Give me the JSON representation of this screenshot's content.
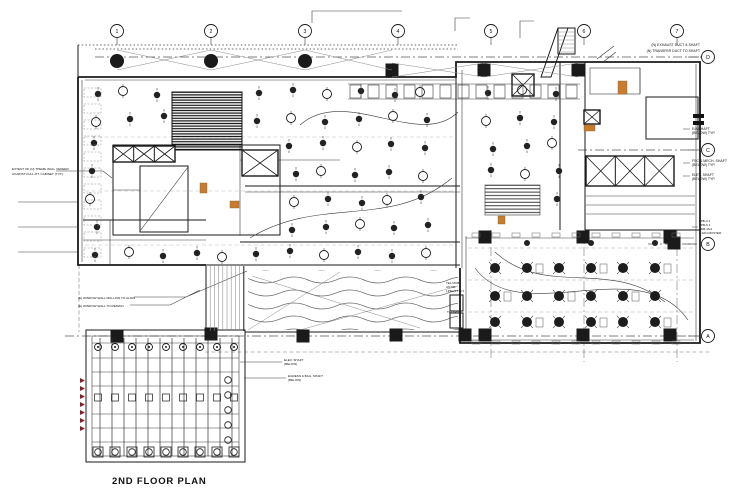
{
  "plan": {
    "title": "2ND FLOOR PLAN"
  },
  "grid": {
    "columns": [
      "1",
      "2",
      "3",
      "4",
      "5",
      "6",
      "7"
    ],
    "rows": [
      "D",
      "C",
      "B",
      "A"
    ]
  },
  "colors": {
    "ink": "#1a1a1a",
    "highlight": "#c87d2e",
    "marker": "#8b1d2c",
    "paper": "#ffffff"
  },
  "annotations": {
    "top_right_1": "(N) EXHAUST DUCT & SHAFT",
    "top_right_2": "(N) TRANSFER DUCT TO SHAFT",
    "right_shaft_1a": "E/A SHAFT",
    "right_shaft_1b": "(BELOW) TYP.",
    "right_shaft_2a": "FSC & MECH. SHAFT",
    "right_shaft_2b": "(BELOW) TYP.",
    "right_shaft_3a": "ELEV. SHAFT",
    "right_shaft_3b": "(BELOW) TYP.",
    "right_tags": [
      "LPB-4.1",
      "TPB-6.1",
      "TDB-16.2",
      "1 FAN MASTER"
    ],
    "left_wall_1": "EXTENT OF (N) THEME WALL VENEER",
    "left_wall_2": "AGAINST FULL-HT. CABINET (TYP.)",
    "left_window_1": "(E) WINDOW WALL MULLION TO ALIGN",
    "left_window_2": "(E) WINDOW WALL TO REMAIN",
    "center_shaft_1a": "ELEV. SHAFT",
    "center_shaft_1b": "(BELOW)",
    "center_shaft_2a": "EGRESS & BAG. SHAFT",
    "center_shaft_2b": "(BELOW)",
    "pool_note_1": "TEL MCB",
    "pool_note_2": "AN DB",
    "pool_note_3": "LPFL/1.TW 2",
    "pool_note_4": "TEL (PT)"
  }
}
